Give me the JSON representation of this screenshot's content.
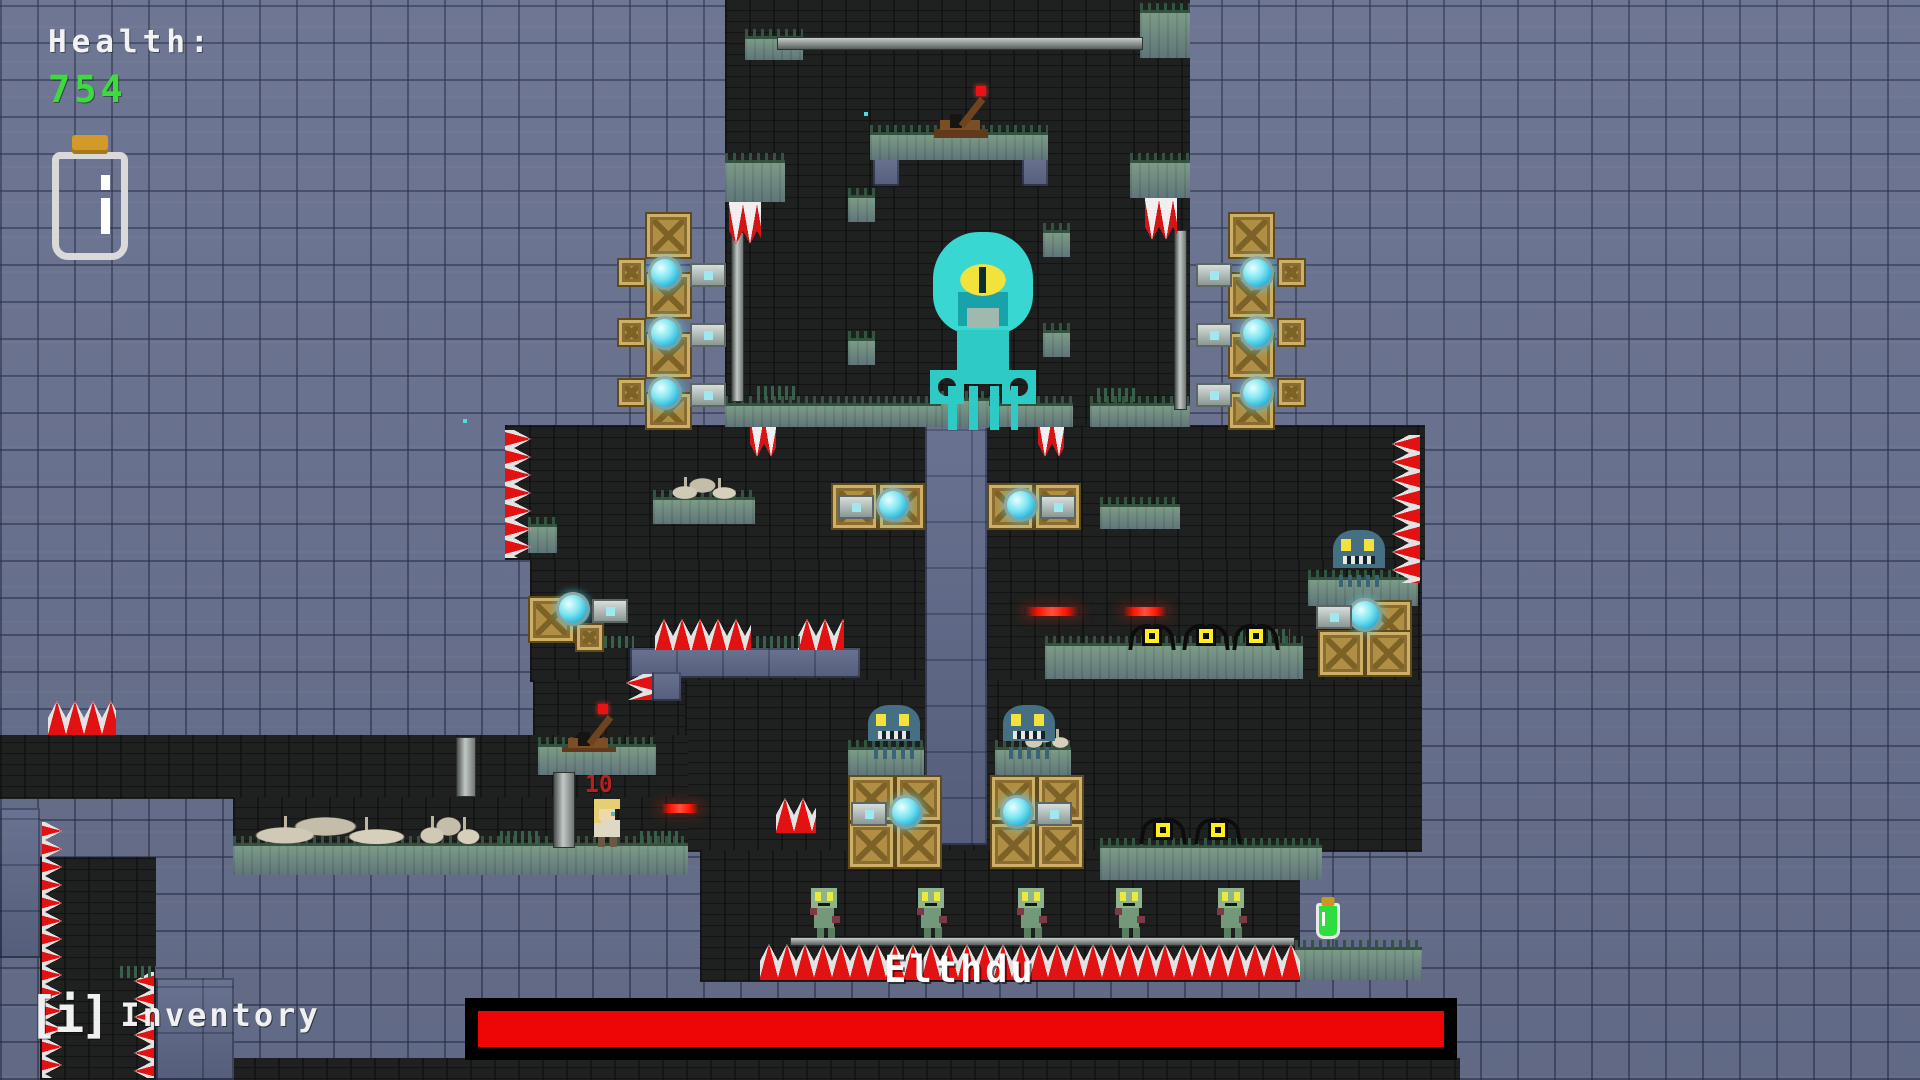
{
  "hud": {
    "health_label": "Health:",
    "health_value": "754",
    "inventory_key": "[i]",
    "inventory_label": "Inventory"
  },
  "boss": {
    "name": "Elthdu",
    "health_percent": 100,
    "bar_color": "#ee0505",
    "bar_frame_color": "#000000"
  },
  "player": {
    "damage_number": "10"
  },
  "colors": {
    "background": "#68718f",
    "cave": "#1e211f",
    "grass": "#6e8b7d",
    "crate_gold": "#b08f44",
    "boss_cyan": "#38d7d2",
    "spike_red": "#e21212",
    "health_green": "#3ddc3d",
    "laser_red": "#ff1500"
  },
  "level": {
    "tiles": [
      {
        "t": "dark",
        "x": 725,
        "y": 0,
        "w": 465,
        "h": 430,
        "n": "boss-chamber"
      },
      {
        "t": "dark",
        "x": 505,
        "y": 425,
        "w": 920,
        "h": 135,
        "n": "mid-band"
      },
      {
        "t": "dark",
        "x": 530,
        "y": 560,
        "w": 892,
        "h": 122,
        "n": "lower-mid-band"
      },
      {
        "t": "dark",
        "x": 533,
        "y": 680,
        "w": 162,
        "h": 125,
        "n": "lever-pocket"
      },
      {
        "t": "dark",
        "x": 685,
        "y": 680,
        "w": 737,
        "h": 172,
        "n": "lower-band"
      },
      {
        "t": "dark",
        "x": 700,
        "y": 850,
        "w": 600,
        "h": 132,
        "n": "zombie-room"
      },
      {
        "t": "dark",
        "x": 0,
        "y": 735,
        "w": 688,
        "h": 64,
        "n": "left-corridor"
      },
      {
        "t": "dark",
        "x": 233,
        "y": 797,
        "w": 455,
        "h": 78,
        "n": "under-corridor"
      },
      {
        "t": "dark",
        "x": 40,
        "y": 857,
        "w": 116,
        "h": 223,
        "n": "left-shaft"
      },
      {
        "t": "dark",
        "x": 230,
        "y": 1058,
        "w": 1230,
        "h": 22,
        "n": "bottom-strip"
      },
      {
        "t": "blue",
        "x": 925,
        "y": 425,
        "w": 62,
        "h": 420,
        "n": "central-column"
      },
      {
        "t": "blue",
        "x": 630,
        "y": 648,
        "w": 230,
        "h": 30
      },
      {
        "t": "blue",
        "x": 652,
        "y": 672,
        "w": 29,
        "h": 29
      },
      {
        "t": "blue",
        "x": 873,
        "y": 158,
        "w": 26,
        "h": 28
      },
      {
        "t": "blue",
        "x": 1022,
        "y": 158,
        "w": 26,
        "h": 28
      },
      {
        "t": "blue",
        "x": 0,
        "y": 808,
        "w": 40,
        "h": 150
      },
      {
        "t": "blue",
        "x": 156,
        "y": 978,
        "w": 78,
        "h": 102
      },
      {
        "t": "grass",
        "x": 745,
        "y": 36,
        "w": 58,
        "h": 24
      },
      {
        "t": "grass",
        "x": 1140,
        "y": 10,
        "w": 50,
        "h": 48
      },
      {
        "t": "grass",
        "x": 870,
        "y": 132,
        "w": 178,
        "h": 28,
        "n": "lever-platform"
      },
      {
        "t": "grass",
        "x": 725,
        "y": 160,
        "w": 60,
        "h": 42
      },
      {
        "t": "grass",
        "x": 1130,
        "y": 160,
        "w": 60,
        "h": 38
      },
      {
        "t": "grass",
        "x": 848,
        "y": 195,
        "w": 27,
        "h": 27
      },
      {
        "t": "grass",
        "x": 848,
        "y": 338,
        "w": 27,
        "h": 27
      },
      {
        "t": "grass",
        "x": 1043,
        "y": 230,
        "w": 27,
        "h": 27
      },
      {
        "t": "grass",
        "x": 1043,
        "y": 330,
        "w": 27,
        "h": 27
      },
      {
        "t": "grass",
        "x": 725,
        "y": 403,
        "w": 120,
        "h": 24
      },
      {
        "t": "grass",
        "x": 845,
        "y": 403,
        "w": 228,
        "h": 24
      },
      {
        "t": "grass",
        "x": 1090,
        "y": 403,
        "w": 100,
        "h": 24
      },
      {
        "t": "grass",
        "x": 941,
        "y": 398,
        "w": 48,
        "h": 30,
        "n": "boss-pedestal"
      },
      {
        "t": "grass",
        "x": 653,
        "y": 497,
        "w": 102,
        "h": 27
      },
      {
        "t": "grass",
        "x": 528,
        "y": 524,
        "w": 29,
        "h": 29
      },
      {
        "t": "grass",
        "x": 1100,
        "y": 504,
        "w": 80,
        "h": 25
      },
      {
        "t": "grass",
        "x": 1045,
        "y": 643,
        "w": 258,
        "h": 36
      },
      {
        "t": "grass",
        "x": 848,
        "y": 747,
        "w": 76,
        "h": 29
      },
      {
        "t": "grass",
        "x": 995,
        "y": 747,
        "w": 76,
        "h": 29
      },
      {
        "t": "grass",
        "x": 1308,
        "y": 577,
        "w": 110,
        "h": 29
      },
      {
        "t": "grass",
        "x": 538,
        "y": 744,
        "w": 118,
        "h": 31
      },
      {
        "t": "grass",
        "x": 233,
        "y": 843,
        "w": 455,
        "h": 32
      },
      {
        "t": "grass",
        "x": 1100,
        "y": 845,
        "w": 222,
        "h": 35
      },
      {
        "t": "grass",
        "x": 1295,
        "y": 947,
        "w": 127,
        "h": 33
      },
      {
        "t": "pole-h",
        "x": 777,
        "y": 37,
        "w": 366,
        "h": 13,
        "n": "ceiling-rail"
      },
      {
        "t": "pole-v",
        "x": 731,
        "y": 232,
        "w": 13,
        "h": 170
      },
      {
        "t": "pole-v",
        "x": 1174,
        "y": 230,
        "w": 13,
        "h": 180
      },
      {
        "t": "pole-v",
        "x": 456,
        "y": 737,
        "w": 20,
        "h": 60
      },
      {
        "t": "pole-v",
        "x": 553,
        "y": 772,
        "w": 22,
        "h": 76
      },
      {
        "t": "pole-h",
        "x": 790,
        "y": 937,
        "w": 505,
        "h": 9,
        "n": "zombie-rail"
      },
      {
        "t": "crate",
        "x": 645,
        "y": 212,
        "w": 47,
        "h": 47
      },
      {
        "t": "crate",
        "x": 645,
        "y": 272,
        "w": 47,
        "h": 47
      },
      {
        "t": "crate",
        "x": 645,
        "y": 332,
        "w": 47,
        "h": 47
      },
      {
        "t": "crate",
        "x": 645,
        "y": 392,
        "w": 47,
        "h": 38
      },
      {
        "t": "crate",
        "x": 617,
        "y": 258,
        "w": 29,
        "h": 29
      },
      {
        "t": "crate",
        "x": 617,
        "y": 318,
        "w": 29,
        "h": 29
      },
      {
        "t": "crate",
        "x": 617,
        "y": 378,
        "w": 29,
        "h": 29
      },
      {
        "t": "crate",
        "x": 1228,
        "y": 212,
        "w": 47,
        "h": 47
      },
      {
        "t": "crate",
        "x": 1228,
        "y": 272,
        "w": 47,
        "h": 47
      },
      {
        "t": "crate",
        "x": 1228,
        "y": 332,
        "w": 47,
        "h": 47
      },
      {
        "t": "crate",
        "x": 1228,
        "y": 392,
        "w": 47,
        "h": 38
      },
      {
        "t": "crate",
        "x": 1277,
        "y": 258,
        "w": 29,
        "h": 29
      },
      {
        "t": "crate",
        "x": 1277,
        "y": 318,
        "w": 29,
        "h": 29
      },
      {
        "t": "crate",
        "x": 1277,
        "y": 378,
        "w": 29,
        "h": 29
      },
      {
        "t": "crate",
        "x": 831,
        "y": 483,
        "w": 47,
        "h": 47
      },
      {
        "t": "crate",
        "x": 878,
        "y": 483,
        "w": 47,
        "h": 47
      },
      {
        "t": "crate",
        "x": 987,
        "y": 483,
        "w": 47,
        "h": 47
      },
      {
        "t": "crate",
        "x": 1034,
        "y": 483,
        "w": 47,
        "h": 47
      },
      {
        "t": "crate",
        "x": 528,
        "y": 596,
        "w": 47,
        "h": 47
      },
      {
        "t": "crate",
        "x": 575,
        "y": 623,
        "w": 29,
        "h": 29
      },
      {
        "t": "crate",
        "x": 848,
        "y": 775,
        "w": 47,
        "h": 47
      },
      {
        "t": "crate",
        "x": 895,
        "y": 775,
        "w": 47,
        "h": 47
      },
      {
        "t": "crate",
        "x": 848,
        "y": 822,
        "w": 47,
        "h": 47
      },
      {
        "t": "crate",
        "x": 895,
        "y": 822,
        "w": 47,
        "h": 47
      },
      {
        "t": "crate",
        "x": 990,
        "y": 775,
        "w": 47,
        "h": 47
      },
      {
        "t": "crate",
        "x": 1037,
        "y": 775,
        "w": 47,
        "h": 47
      },
      {
        "t": "crate",
        "x": 990,
        "y": 822,
        "w": 47,
        "h": 47
      },
      {
        "t": "crate",
        "x": 1037,
        "y": 822,
        "w": 47,
        "h": 47
      },
      {
        "t": "crate",
        "x": 1365,
        "y": 600,
        "w": 47,
        "h": 47
      },
      {
        "t": "crate",
        "x": 1318,
        "y": 630,
        "w": 47,
        "h": 47
      },
      {
        "t": "crate",
        "x": 1365,
        "y": 630,
        "w": 47,
        "h": 47
      },
      {
        "t": "turret-r",
        "x": 648,
        "y": 256,
        "w": 78,
        "h": 34
      },
      {
        "t": "turret-r",
        "x": 648,
        "y": 316,
        "w": 78,
        "h": 34
      },
      {
        "t": "turret-r",
        "x": 648,
        "y": 376,
        "w": 78,
        "h": 34
      },
      {
        "t": "turret-l",
        "x": 1196,
        "y": 256,
        "w": 78,
        "h": 34
      },
      {
        "t": "turret-l",
        "x": 1196,
        "y": 316,
        "w": 78,
        "h": 34
      },
      {
        "t": "turret-l",
        "x": 1196,
        "y": 376,
        "w": 78,
        "h": 34
      },
      {
        "t": "turret-l",
        "x": 838,
        "y": 488,
        "w": 72,
        "h": 34
      },
      {
        "t": "turret-r",
        "x": 1004,
        "y": 488,
        "w": 72,
        "h": 34
      },
      {
        "t": "turret-r",
        "x": 556,
        "y": 592,
        "w": 72,
        "h": 34
      },
      {
        "t": "turret-l",
        "x": 851,
        "y": 795,
        "w": 72,
        "h": 34
      },
      {
        "t": "turret-r",
        "x": 1000,
        "y": 795,
        "w": 72,
        "h": 34
      },
      {
        "t": "turret-l",
        "x": 1316,
        "y": 598,
        "w": 66,
        "h": 32
      },
      {
        "t": "spikes-right",
        "x": 505,
        "y": 430,
        "w": 26,
        "h": 128
      },
      {
        "t": "spikes-left",
        "x": 1392,
        "y": 435,
        "w": 28,
        "h": 148
      },
      {
        "t": "spikes-up",
        "x": 655,
        "y": 619,
        "w": 96,
        "h": 31
      },
      {
        "t": "spikes-up",
        "x": 798,
        "y": 619,
        "w": 46,
        "h": 31
      },
      {
        "t": "spikes-left",
        "x": 626,
        "y": 674,
        "w": 26,
        "h": 26
      },
      {
        "t": "spikes-up",
        "x": 776,
        "y": 798,
        "w": 40,
        "h": 35
      },
      {
        "t": "spikes-up",
        "x": 760,
        "y": 944,
        "w": 540,
        "h": 36,
        "n": "pit-spikes"
      },
      {
        "t": "spikes-up",
        "x": 48,
        "y": 701,
        "w": 68,
        "h": 34
      },
      {
        "t": "spikes-right",
        "x": 42,
        "y": 822,
        "w": 20,
        "h": 256
      },
      {
        "t": "spikes-left",
        "x": 134,
        "y": 972,
        "w": 20,
        "h": 106
      },
      {
        "t": "spikes-down",
        "x": 729,
        "y": 202,
        "w": 32,
        "h": 42
      },
      {
        "t": "spikes-down",
        "x": 1145,
        "y": 198,
        "w": 32,
        "h": 42
      },
      {
        "t": "spikes-down",
        "x": 750,
        "y": 427,
        "w": 26,
        "h": 30
      },
      {
        "t": "spikes-down",
        "x": 1038,
        "y": 427,
        "w": 26,
        "h": 30
      },
      {
        "t": "bones",
        "x": 672,
        "y": 477,
        "w": 64,
        "h": 22
      },
      {
        "t": "bones",
        "x": 1025,
        "y": 728,
        "w": 44,
        "h": 20
      },
      {
        "t": "bones",
        "x": 255,
        "y": 816,
        "w": 150,
        "h": 28,
        "n": "ruins"
      },
      {
        "t": "bones",
        "x": 420,
        "y": 816,
        "w": 60,
        "h": 28,
        "n": "ruins"
      },
      {
        "t": "tuft",
        "x": 757,
        "y": 386,
        "w": 38,
        "h": 14
      },
      {
        "t": "tuft",
        "x": 1097,
        "y": 388,
        "w": 40,
        "h": 14
      },
      {
        "t": "tuft",
        "x": 604,
        "y": 636,
        "w": 30,
        "h": 12
      },
      {
        "t": "tuft",
        "x": 756,
        "y": 636,
        "w": 44,
        "h": 12
      },
      {
        "t": "tuft",
        "x": 1240,
        "y": 629,
        "w": 50,
        "h": 14
      },
      {
        "t": "tuft",
        "x": 500,
        "y": 831,
        "w": 40,
        "h": 13
      },
      {
        "t": "tuft",
        "x": 640,
        "y": 831,
        "w": 40,
        "h": 13
      },
      {
        "t": "tuft",
        "x": 120,
        "y": 966,
        "w": 36,
        "h": 12
      },
      {
        "t": "particle",
        "x": 463,
        "y": 419,
        "w": 4,
        "h": 4
      },
      {
        "t": "particle",
        "x": 864,
        "y": 112,
        "w": 4,
        "h": 4
      },
      {
        "t": "boss",
        "x": 928,
        "y": 232,
        "w": 110,
        "h": 200,
        "n": "boss-squid"
      },
      {
        "t": "squid",
        "x": 868,
        "y": 705,
        "w": 52,
        "h": 45,
        "n": "squid-enemy"
      },
      {
        "t": "squid",
        "x": 1003,
        "y": 705,
        "w": 52,
        "h": 45,
        "n": "squid-enemy"
      },
      {
        "t": "squid",
        "x": 1333,
        "y": 530,
        "w": 52,
        "h": 48,
        "n": "squid-enemy"
      },
      {
        "t": "zombie",
        "x": 810,
        "y": 888,
        "w": 32,
        "h": 50,
        "n": "zombie-enemy"
      },
      {
        "t": "zombie",
        "x": 917,
        "y": 888,
        "w": 32,
        "h": 50,
        "n": "zombie-enemy"
      },
      {
        "t": "zombie",
        "x": 1017,
        "y": 888,
        "w": 32,
        "h": 50,
        "n": "zombie-enemy"
      },
      {
        "t": "zombie",
        "x": 1115,
        "y": 888,
        "w": 32,
        "h": 50,
        "n": "zombie-enemy"
      },
      {
        "t": "zombie",
        "x": 1217,
        "y": 888,
        "w": 32,
        "h": 50,
        "n": "zombie-enemy"
      },
      {
        "t": "bat",
        "x": 1130,
        "y": 624,
        "w": 44,
        "h": 26,
        "n": "bat-enemy"
      },
      {
        "t": "bat",
        "x": 1184,
        "y": 624,
        "w": 44,
        "h": 26,
        "n": "bat-enemy"
      },
      {
        "t": "bat",
        "x": 1234,
        "y": 624,
        "w": 44,
        "h": 26,
        "n": "bat-enemy"
      },
      {
        "t": "bat",
        "x": 1141,
        "y": 818,
        "w": 44,
        "h": 28,
        "n": "bat-enemy"
      },
      {
        "t": "bat",
        "x": 1196,
        "y": 818,
        "w": 44,
        "h": 28,
        "n": "bat-enemy"
      },
      {
        "t": "player",
        "x": 590,
        "y": 799,
        "w": 34,
        "h": 48,
        "n": "player-character"
      },
      {
        "t": "lever",
        "x": 932,
        "y": 90,
        "w": 62,
        "h": 48,
        "n": "lever"
      },
      {
        "t": "lever",
        "x": 560,
        "y": 708,
        "w": 56,
        "h": 44,
        "n": "lever"
      },
      {
        "t": "laser",
        "x": 1024,
        "y": 607,
        "w": 56,
        "h": 9,
        "n": "red-laser"
      },
      {
        "t": "laser",
        "x": 1122,
        "y": 607,
        "w": 46,
        "h": 9,
        "n": "red-laser"
      },
      {
        "t": "laser",
        "x": 660,
        "y": 804,
        "w": 40,
        "h": 9,
        "n": "red-laser"
      },
      {
        "t": "potion-sm",
        "x": 1316,
        "y": 903,
        "w": 24,
        "h": 36,
        "n": "green-potion-pickup"
      }
    ]
  }
}
